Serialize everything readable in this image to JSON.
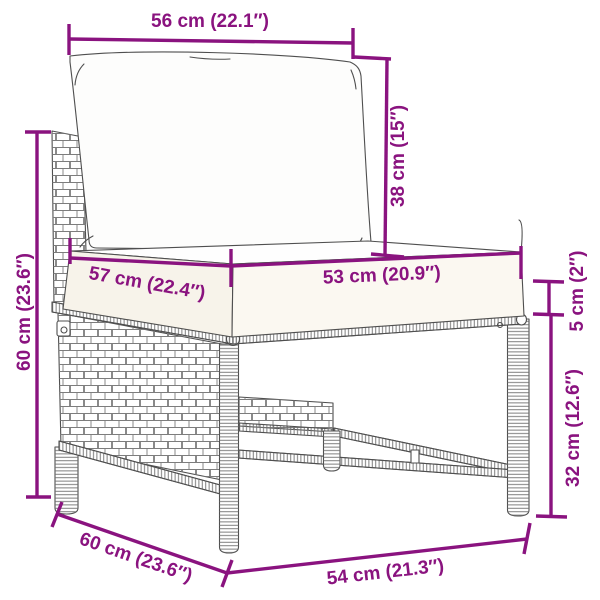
{
  "diagram": {
    "accent_color": "#8A137F",
    "line_color": "#4f4f4f",
    "dimensions": {
      "back_cushion_width": "56 cm (22.1″)",
      "back_cushion_height": "38 cm (15″)",
      "overall_height": "60 cm (23.6″)",
      "top_depth": "57 cm (22.4″)",
      "seat_cushion_width": "53 cm (20.9″)",
      "cushion_thickness": "5 cm (2″)",
      "frame_height": "32 cm (12.6″)",
      "base_depth": "60 cm (23.6″)",
      "base_width": "54 cm (21.3″)"
    }
  }
}
